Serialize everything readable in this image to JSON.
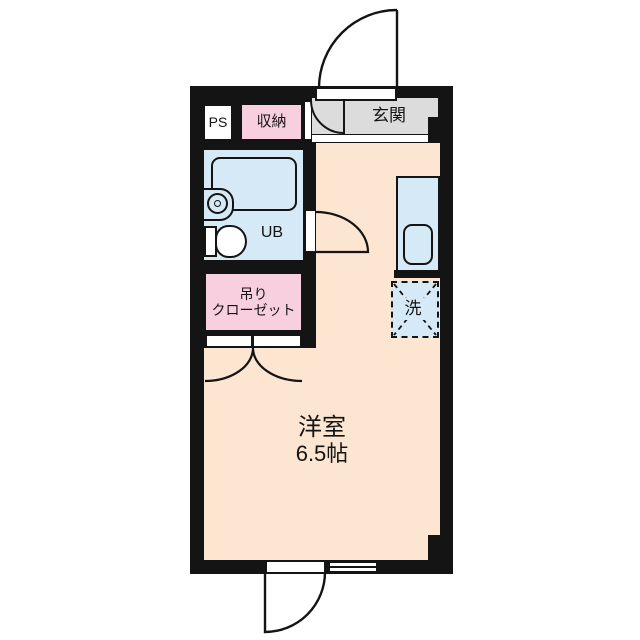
{
  "floorplan": {
    "labels": {
      "ps": "PS",
      "storage": "収納",
      "entrance": "玄関",
      "unit_bath": "UB",
      "closet_line1": "吊り",
      "closet_line2": "クローゼット",
      "washer": "洗",
      "room_name": "洋室",
      "room_size": "6.5帖"
    },
    "colors": {
      "wall": "#141414",
      "room_floor": "#fce5d1",
      "wet_area": "#d5e9f6",
      "closet_pink": "#f8cfdf",
      "entrance_gray": "#dcdcdc",
      "background": "#ffffff"
    },
    "icons": [
      "bathtub-icon",
      "toilet-icon",
      "washbasin-icon",
      "kitchen-sink-icon",
      "door-swing-arc",
      "double-door-arc",
      "window-symbol",
      "washer-space-cross"
    ]
  }
}
